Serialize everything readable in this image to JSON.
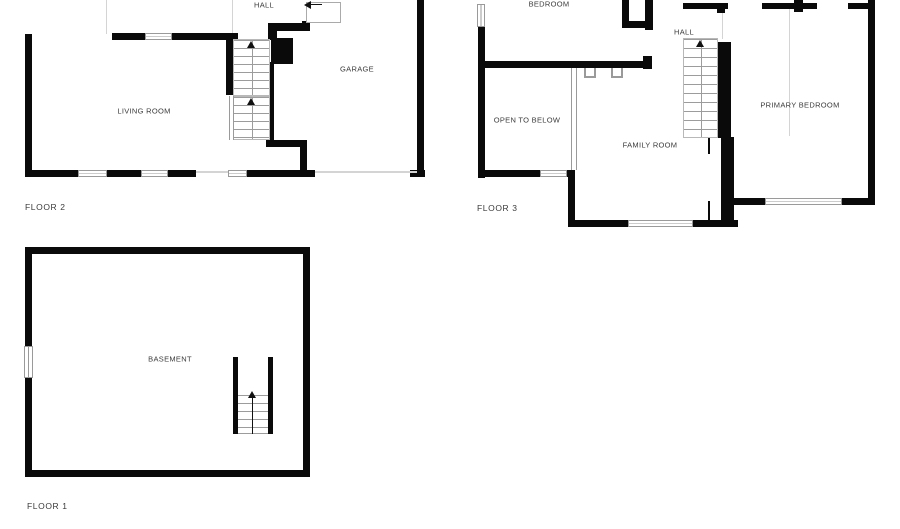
{
  "colors": {
    "wall": "#0a0a0a",
    "bg": "#ffffff",
    "frame": "#9a9a9a",
    "faint": "#d4d4d4",
    "text": "#3b3b3b"
  },
  "icons": {
    "up_arrow": "stairs-direction-up",
    "left_arrow": "stairs-direction-left"
  },
  "floors": [
    {
      "id": "floor-2",
      "label": "FLOOR 2",
      "rooms": {
        "hall": "HALL",
        "living_room": "LIVING ROOM",
        "garage": "GARAGE"
      }
    },
    {
      "id": "floor-3",
      "label": "FLOOR 3",
      "rooms": {
        "bedroom": "BEDROOM",
        "hall": "HALL",
        "open_to_below": "OPEN TO BELOW",
        "family_room": "FAMILY ROOM",
        "primary_bedroom": "PRIMARY BEDROOM"
      }
    },
    {
      "id": "floor-1",
      "label": "FLOOR 1",
      "rooms": {
        "basement": "BASEMENT"
      }
    }
  ]
}
